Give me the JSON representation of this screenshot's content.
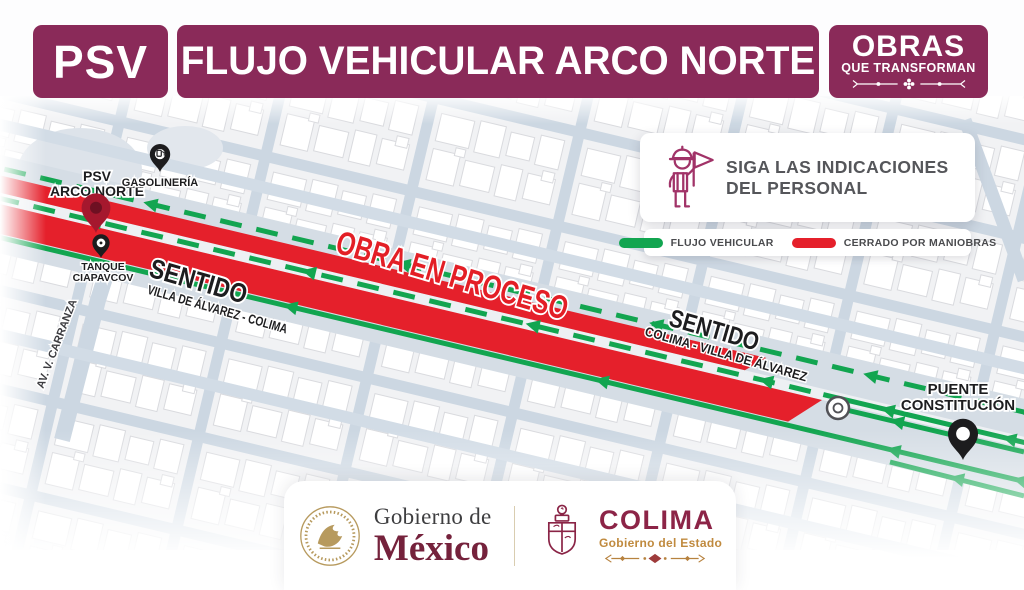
{
  "header": {
    "psv": "PSV",
    "title": "FLUJO VEHICULAR ARCO NORTE",
    "badge": {
      "line1": "OBRAS",
      "line2": "QUE TRANSFORMAN"
    }
  },
  "legend": {
    "instruction": {
      "line1": "SIGA LAS INDICACIONES",
      "line2": "DEL PERSONAL"
    },
    "items": [
      {
        "label": "FLUJO VEHICULAR",
        "color": "#12A550"
      },
      {
        "label": "CERRADO POR MANIOBRAS",
        "color": "#E5202B"
      }
    ]
  },
  "map": {
    "status_label": "OBRA EN PROCESO",
    "pois": {
      "psv": {
        "line1": "PSV",
        "line2": "ARCO NORTE"
      },
      "gas": {
        "label": "GASOLINERÍA"
      },
      "tank": {
        "line1": "TANQUE",
        "line2": "CIAPAVCOV"
      },
      "bridge": {
        "line1": "PUENTE",
        "line2": "CONSTITUCIÓN"
      }
    },
    "streets": {
      "carranza": "AV. V. CARRANZA"
    },
    "directions": {
      "left": {
        "title": "SENTIDO",
        "subtitle": "VILLA DE ÁLVAREZ - COLIMA"
      },
      "right": {
        "title": "SENTIDO",
        "subtitle": "COLIMA - VILLA DE ÁLVAREZ"
      }
    }
  },
  "footer": {
    "mexico": {
      "line1": "Gobierno de",
      "line2": "México"
    },
    "colima": {
      "title": "COLIMA",
      "subtitle": "Gobierno del Estado"
    }
  },
  "colors": {
    "brand_maroon": "#8A2A59",
    "flow_green": "#12A550",
    "closed_red": "#E5202B",
    "pin_dark_red": "#A5182E",
    "street_blue": "#ccd7e2"
  }
}
